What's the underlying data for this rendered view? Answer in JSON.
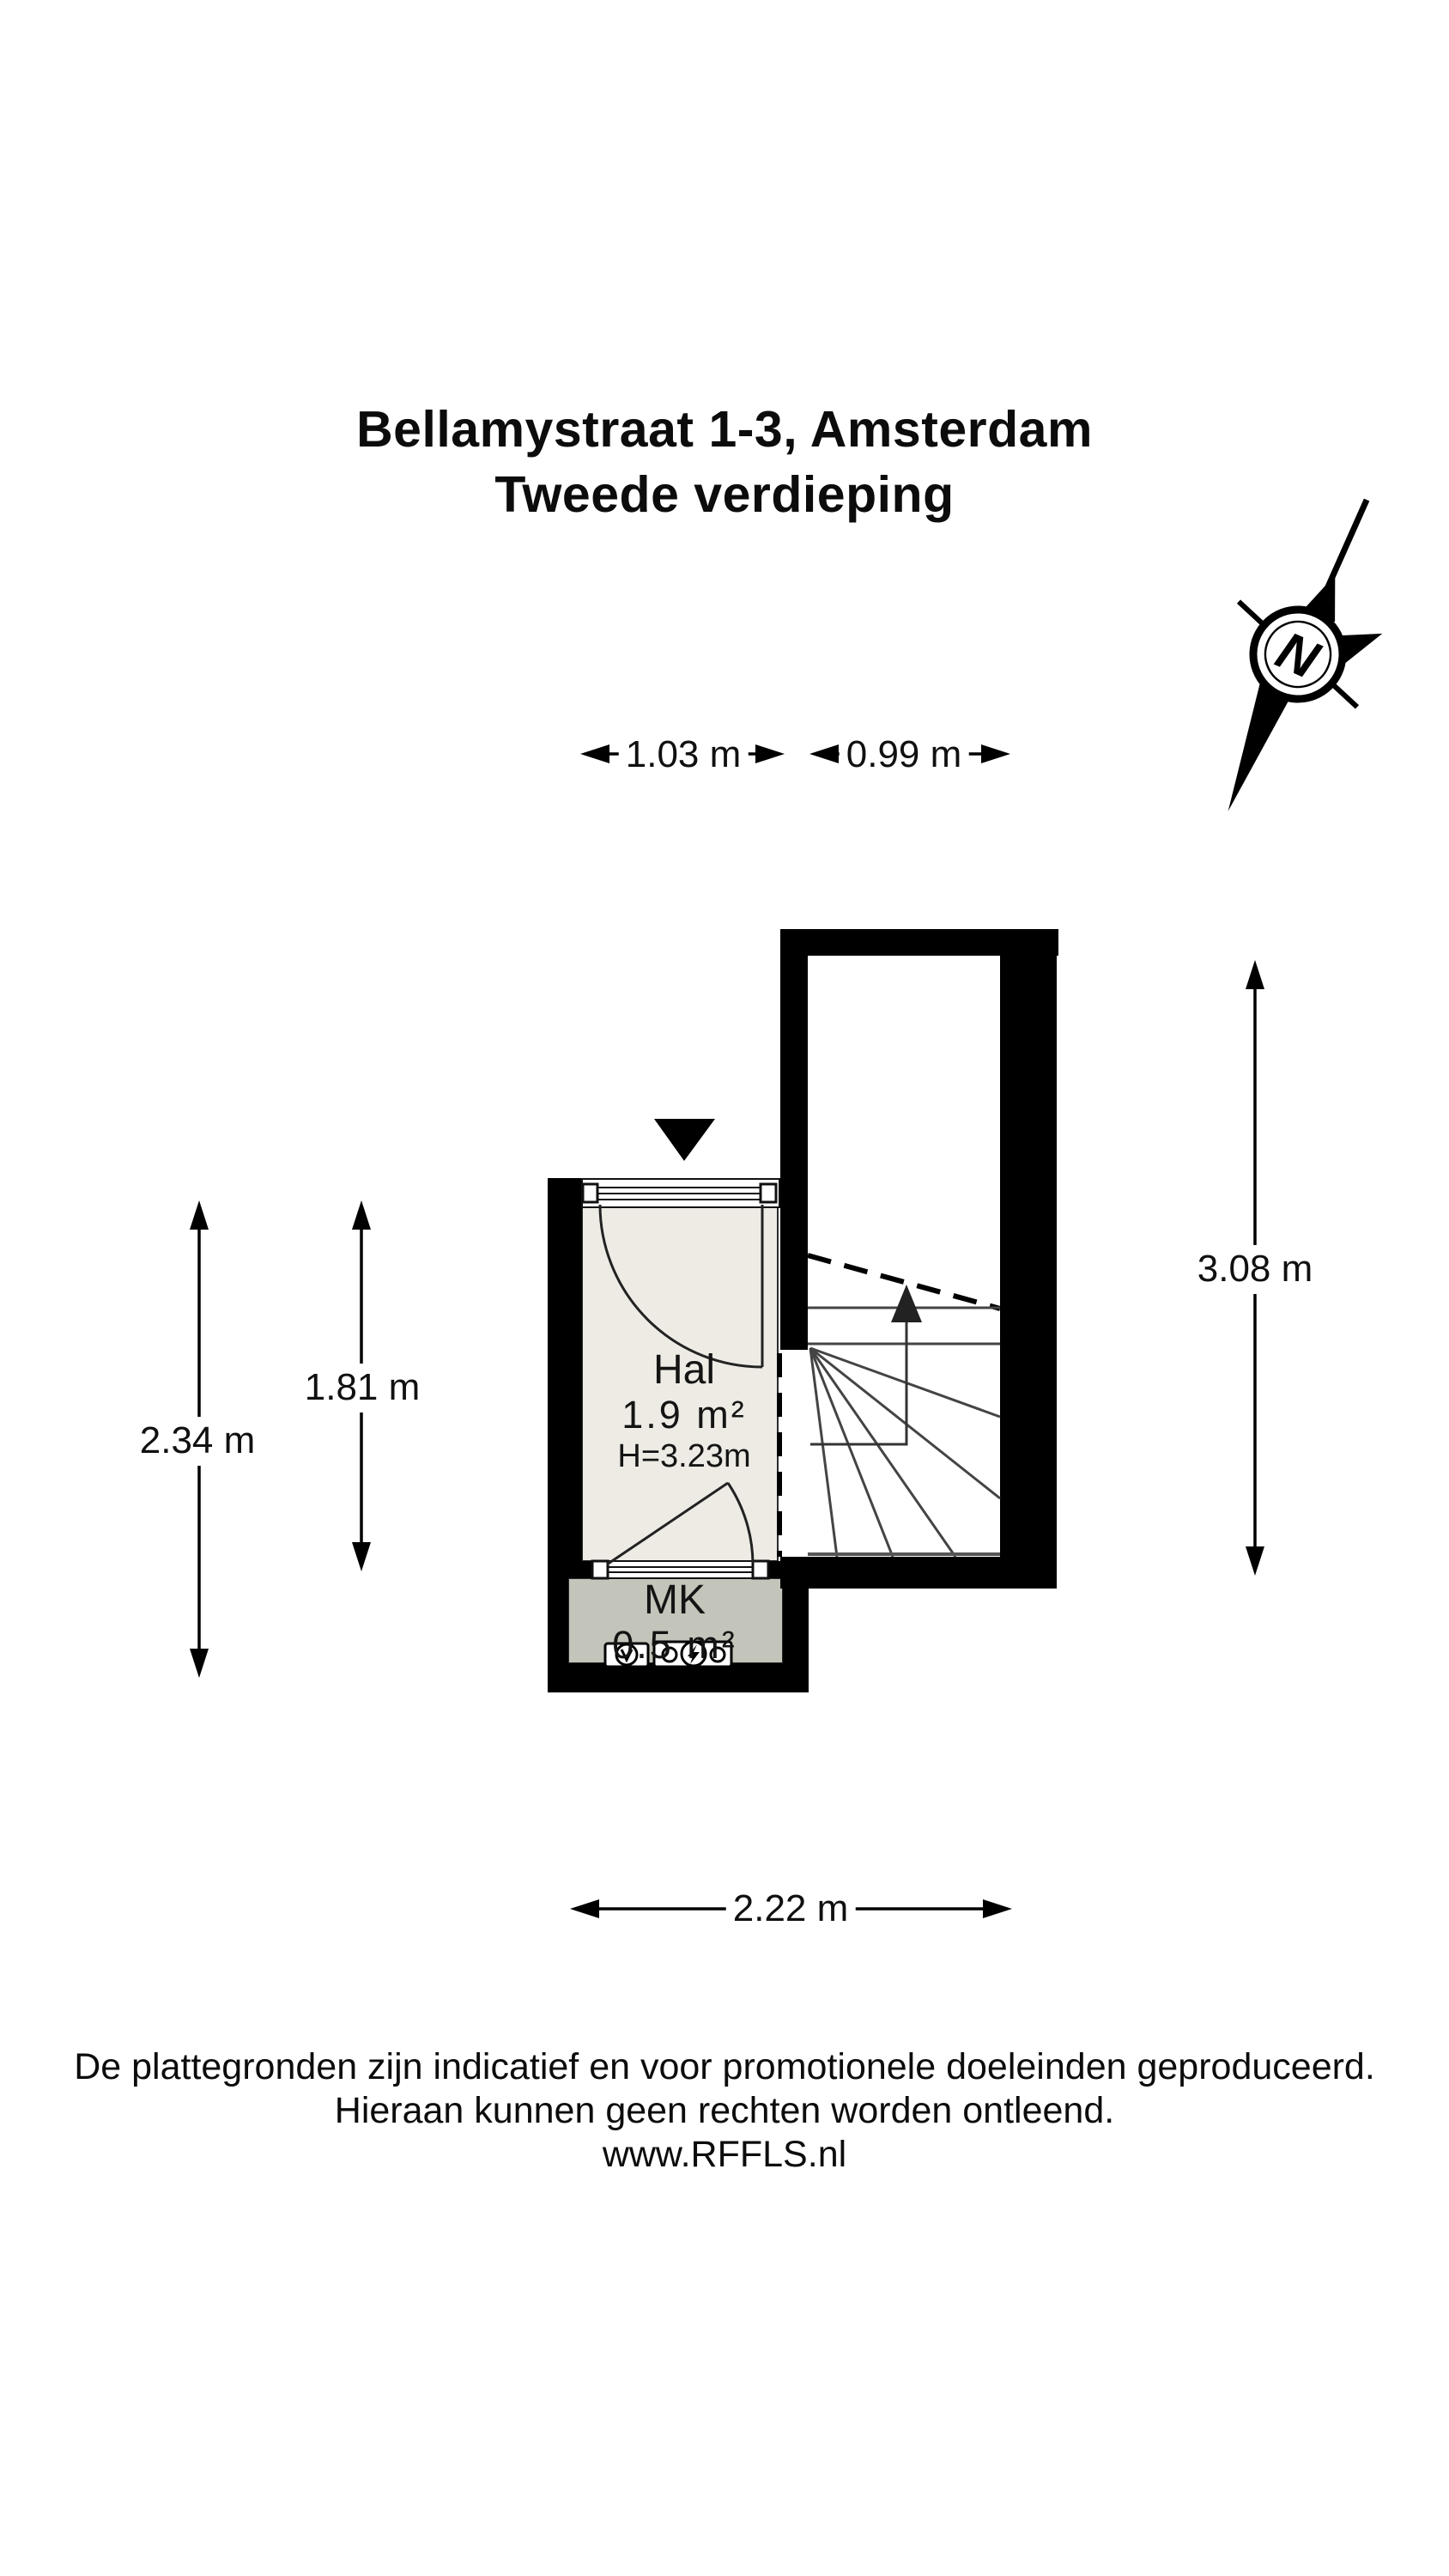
{
  "title": {
    "line1": "Bellamystraat 1-3, Amsterdam",
    "line2": "Tweede verdieping"
  },
  "compass": {
    "label": "N"
  },
  "plan": {
    "rooms": [
      {
        "name": "Hal",
        "area": "1.9 m²",
        "ceiling_height": "H=3.23m"
      },
      {
        "name": "MK",
        "area": "0.5 m²"
      }
    ]
  },
  "dimensions": {
    "top_left_width": "1.03 m",
    "top_right_width": "0.99 m",
    "outer_left_height": "2.34 m",
    "inner_left_height": "1.81 m",
    "right_height": "3.08 m",
    "bottom_width": "2.22 m"
  },
  "footer": {
    "line1": "De plattegronden zijn indicatief en voor promotionele doeleinden geproduceerd.",
    "line2": "Hieraan kunnen geen rechten worden ontleend.",
    "line3": "www.RFFLS.nl"
  },
  "colors": {
    "wall": "#000000",
    "hal_floor": "#edebe4",
    "mk_floor": "#c3c4ba",
    "line": "#333333"
  }
}
